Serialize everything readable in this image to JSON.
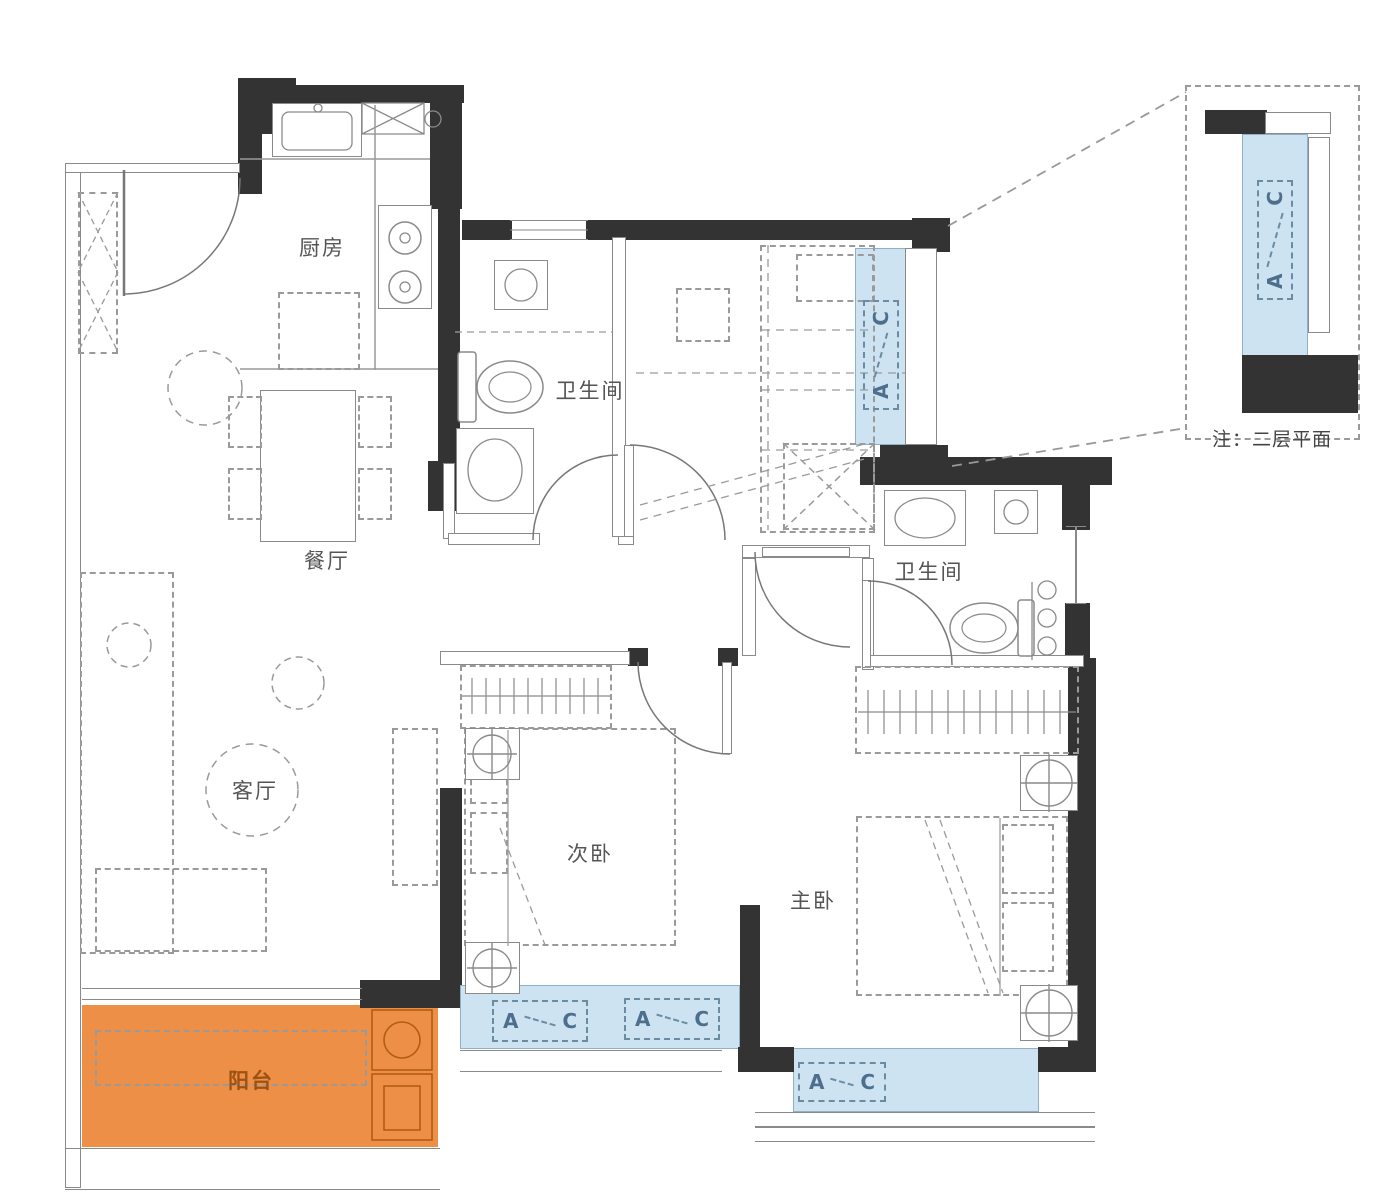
{
  "plan_title": "户型平面图",
  "rooms": {
    "kitchen": {
      "label": "厨房"
    },
    "dining": {
      "label": "餐厅"
    },
    "bath_top": {
      "label": "卫生间"
    },
    "bath_master": {
      "label": "卫生间"
    },
    "living": {
      "label": "客厅"
    },
    "bedroom_second": {
      "label": "次卧"
    },
    "bedroom_master": {
      "label": "主卧"
    },
    "balcony": {
      "label": "阳台"
    }
  },
  "window_marks": {
    "a": "A",
    "c": "C"
  },
  "inset": {
    "note": "注：二层平面"
  },
  "colors": {
    "wall": "#333333",
    "window_fill": "#cde3f2",
    "balcony_fill": "#ee8f47",
    "line": "#8a8a8a",
    "label_text": "#555555",
    "window_mark_text": "#4d6f8c",
    "balcony_stroke": "#b35c13"
  }
}
